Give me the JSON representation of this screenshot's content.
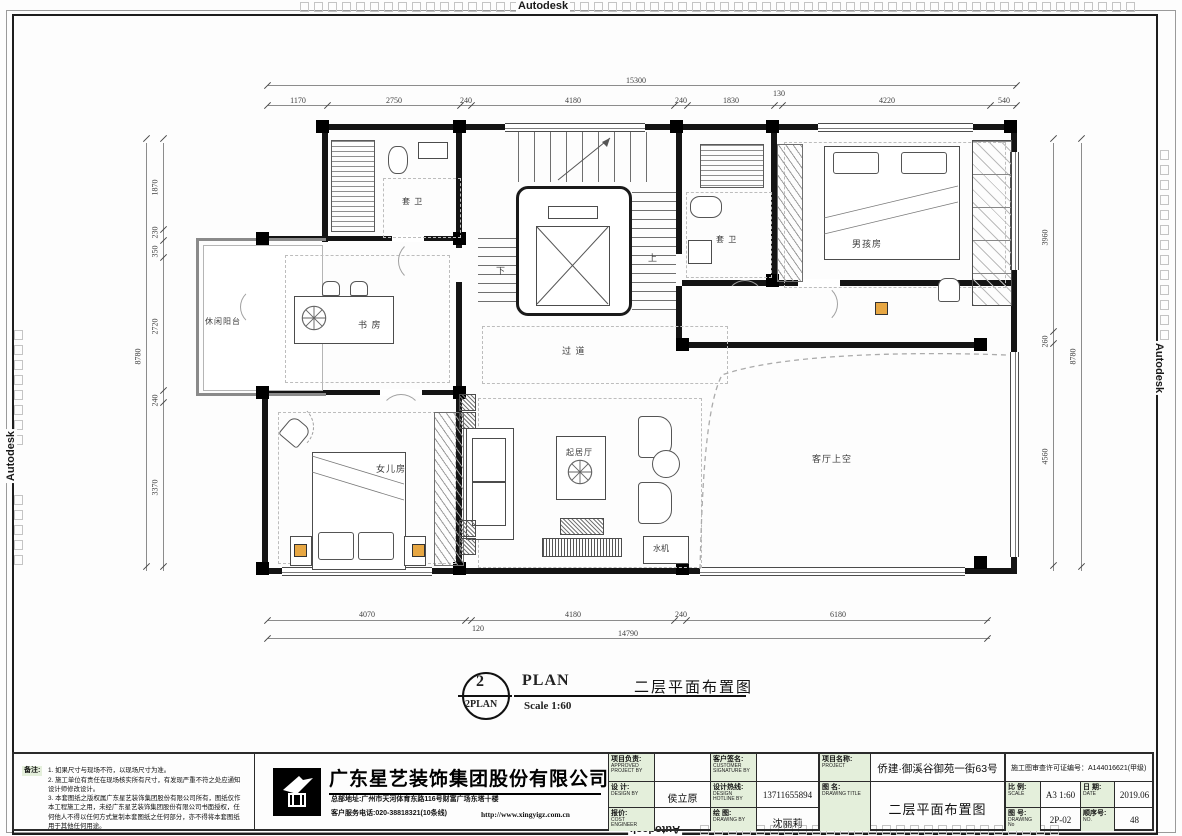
{
  "watermark": {
    "brand": "Autodesk"
  },
  "dims": {
    "top": {
      "overall": "15300",
      "segments": [
        "1170",
        "2750",
        "240",
        "4180",
        "240",
        "1830",
        "130",
        "4220",
        "540"
      ]
    },
    "bottom": {
      "overall": "14790",
      "segments": [
        "4070",
        "120",
        "4180",
        "240",
        "6180"
      ]
    },
    "left": {
      "overall": "8780",
      "segments": [
        "1870",
        "230",
        "350",
        "2720",
        "240",
        "3370"
      ]
    },
    "right": {
      "overall": "8780",
      "segments": [
        "3960",
        "260",
        "4560"
      ]
    }
  },
  "rooms": {
    "balcony": "休闲阳台",
    "study": "书 房",
    "bath_left": "套 卫",
    "bath_right": "套 卫",
    "corridor": "过 道",
    "boys_room": "男孩房",
    "daughters_room": "女儿房",
    "living": "起居厅",
    "void_above": "客厅上空",
    "water_machine": "水机",
    "stair_up": "上",
    "stair_down": "下"
  },
  "plan_title": {
    "number": "2",
    "ref": "2PLAN",
    "title": "PLAN",
    "scale": "Scale  1:60",
    "name_cn": "二层平面布置图"
  },
  "notes": {
    "label": "备注:",
    "line1": "1. 如果尺寸与现场不符，以现场尺寸为准。",
    "line2": "2. 施工单位有责任在现场核实所有尺寸，有发现严重不符之处应通知设计师修改设计。",
    "line3": "3. 本套图纸之版权属广东星艺装饰集团股份有限公司所有，图纸仅作本工程施工之用，未经广东星艺装饰集团股份有限公司书面授权，任何他人不得以任何方式复制本套图纸之任何部分，亦不得将本套图纸用于其他任何用途。"
  },
  "company": {
    "name": "广东星艺装饰集团股份有限公司",
    "address": "总部地址:广州市天河体育东路116号财富广场东塔十楼",
    "phone": "客户服务电话:020-38818321(10条线)",
    "website": "http://www.xingyigz.com.cn"
  },
  "titleblock": {
    "approved_label": "项目负责:",
    "approved_en": "APPROVED\nPROJECT BY",
    "approved_value": "",
    "customer_label": "客户签名:",
    "customer_en": "CUSTOMER\nSIGNATURE BY",
    "customer_value": "",
    "design_label": "设 计:",
    "design_en": "DESIGN BY",
    "design_value": "侯立原",
    "hotline_label": "设计热线:",
    "hotline_en": "DESIGN\nHOTLINE BY",
    "hotline_value": "13711655894",
    "cost_label": "报价:",
    "cost_en": "COST ENGINEER",
    "cost_value": "",
    "drawnby_label": "绘 图:",
    "drawnby_en": "DRAWING BY",
    "drawnby_value": "沈丽莉",
    "project_label": "项目名称:",
    "project_en": "PROJECT",
    "project_value": "侨建·御溪谷御苑一街63号",
    "title_label": "图 名:",
    "title_en": "DRAWING TITLE",
    "title_value": "二层平面布置图",
    "permit": "施工图审查许可证编号：A144016621(甲级)",
    "scale_label": "比 例:",
    "scale_en": "SCALE",
    "scale_value": "A3 1:60",
    "date_label": "日 期:",
    "date_en": "DATE",
    "date_value": "2019.06",
    "no_label": "图 号:",
    "no_en": "DRAWING No",
    "no_value": "2P-02",
    "seq_label": "顺序号:",
    "seq_en": "NO.",
    "seq_value": "48"
  }
}
